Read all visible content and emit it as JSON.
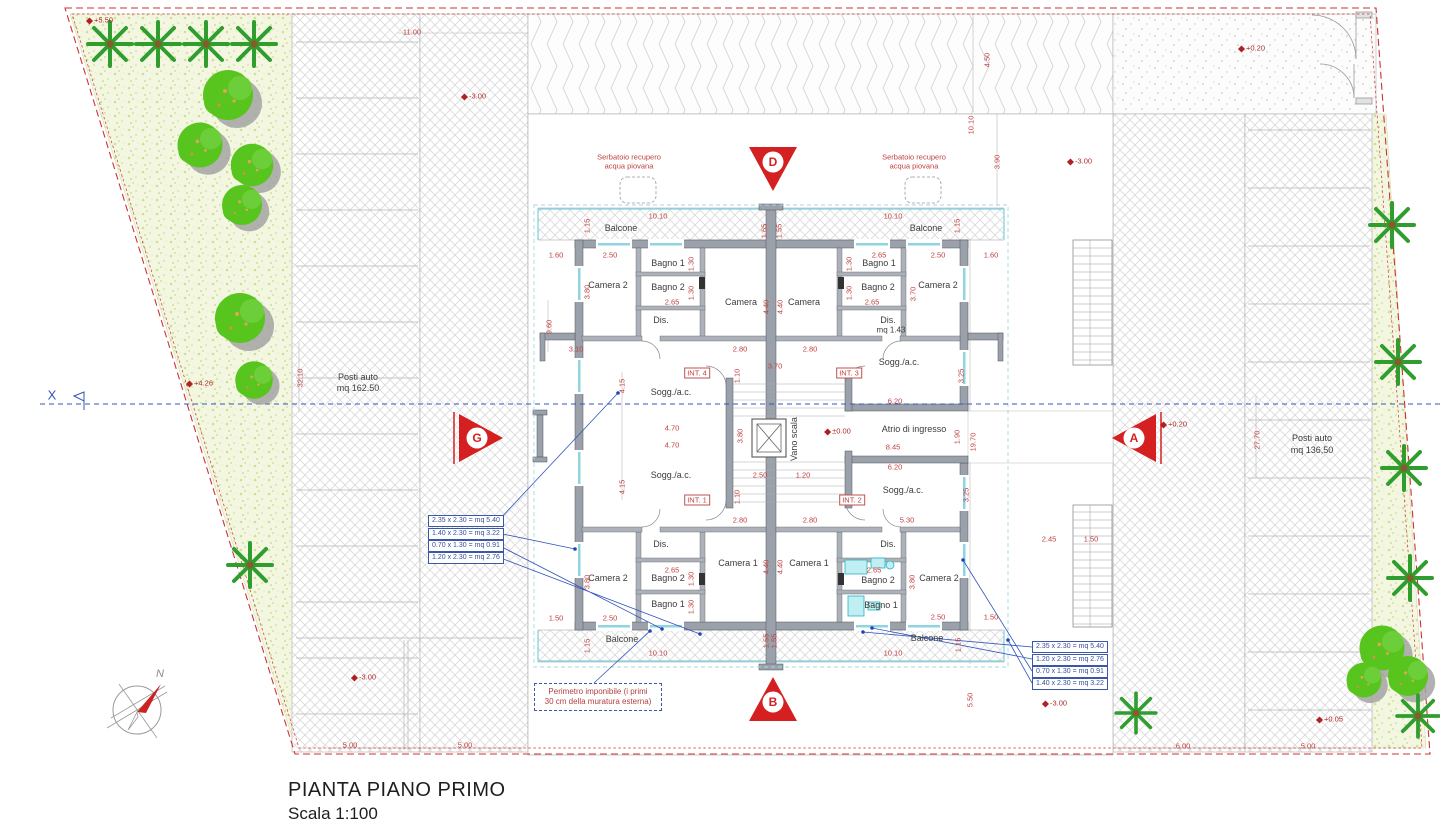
{
  "title_block": {
    "title": "PIANTA PIANO PRIMO",
    "scale": "Scala 1:100"
  },
  "axis": {
    "label": "X"
  },
  "compass": {
    "north": "N"
  },
  "colors": {
    "dimension_red": "#c04040",
    "boundary_red": "#cc3333",
    "axis_blue": "#3355bb",
    "annotation_blue": "#35509c",
    "wall_gray": "#9ba1aa",
    "tree_green": "#55c41e",
    "fixture_cyan": "#2ab3c0",
    "marker_red": "#d42020"
  },
  "annotations": {
    "left": [
      "2.35 x 2.30 = mq 5.40",
      "1.40 x 2.30 = mq 3.22",
      "0.70 x 1.30 = mq 0.91",
      "1.20 x 2.30 = mq 2.76"
    ],
    "right": [
      "2.35 x 2.30 = mq 5.40",
      "1.20 x 2.30 = mq 2.76",
      "0.70 x 1.30 = mq 0.91",
      "1.40 x 2.30 = mq 3.22"
    ]
  },
  "perimeter_note": {
    "line1": "Perimetro imponibile (i primi",
    "line2": "30 cm della muratura esterna)"
  },
  "labels": [
    {
      "t": "+5.50",
      "x": 100,
      "y": 20,
      "c": "level",
      "n": "level-marker"
    },
    {
      "t": "11.00",
      "x": 412,
      "y": 32,
      "c": "dim",
      "n": "dimension-label"
    },
    {
      "t": "-3.00",
      "x": 474,
      "y": 96,
      "c": "level",
      "n": "level-marker"
    },
    {
      "t": "+0.20",
      "x": 1252,
      "y": 48,
      "c": "level",
      "n": "level-marker"
    },
    {
      "t": "4.50",
      "x": 987,
      "y": 60,
      "c": "dimv",
      "n": "dimension-label"
    },
    {
      "t": "10.10",
      "x": 971,
      "y": 125,
      "c": "dimv",
      "n": "dimension-label"
    },
    {
      "t": "3.90",
      "x": 997,
      "y": 162,
      "c": "dimv",
      "n": "dimension-label"
    },
    {
      "t": "-3.00",
      "x": 1080,
      "y": 161,
      "c": "level",
      "n": "level-marker"
    },
    {
      "t": "+4.26",
      "x": 200,
      "y": 383,
      "c": "level",
      "n": "level-marker"
    },
    {
      "t": "Posti auto",
      "x": 358,
      "y": 377,
      "c": "room",
      "n": "parking-label"
    },
    {
      "t": "mq 162.50",
      "x": 358,
      "y": 388,
      "c": "room",
      "n": "parking-label"
    },
    {
      "t": "32.10",
      "x": 300,
      "y": 378,
      "c": "dimv",
      "n": "dimension-label"
    },
    {
      "t": "Posti auto",
      "x": 1312,
      "y": 438,
      "c": "room",
      "n": "parking-label"
    },
    {
      "t": "mq 136,50",
      "x": 1312,
      "y": 450,
      "c": "room",
      "n": "parking-label"
    },
    {
      "t": "27.70",
      "x": 1257,
      "y": 440,
      "c": "dimv",
      "n": "dimension-label"
    },
    {
      "t": "Serbatoio recupero",
      "x": 629,
      "y": 157,
      "c": "red-note",
      "n": "tank-label"
    },
    {
      "t": "acqua piovana",
      "x": 629,
      "y": 166,
      "c": "red-note",
      "n": "tank-label"
    },
    {
      "t": "Serbatoio recupero",
      "x": 914,
      "y": 157,
      "c": "red-note",
      "n": "tank-label"
    },
    {
      "t": "acqua piovana",
      "x": 914,
      "y": 166,
      "c": "red-note",
      "n": "tank-label"
    },
    {
      "t": "10.10",
      "x": 658,
      "y": 216,
      "c": "dim",
      "n": "dimension-label"
    },
    {
      "t": "10.10",
      "x": 893,
      "y": 216,
      "c": "dim",
      "n": "dimension-label"
    },
    {
      "t": "Balcone",
      "x": 621,
      "y": 228,
      "c": "room",
      "n": "room-label"
    },
    {
      "t": "Balcone",
      "x": 926,
      "y": 228,
      "c": "room",
      "n": "room-label"
    },
    {
      "t": "1.15",
      "x": 587,
      "y": 226,
      "c": "dimv",
      "n": "dimension-label"
    },
    {
      "t": "1.15",
      "x": 957,
      "y": 226,
      "c": "dimv",
      "n": "dimension-label"
    },
    {
      "t": "1.65",
      "x": 764,
      "y": 231,
      "c": "dimv",
      "n": "dimension-label"
    },
    {
      "t": "1.55",
      "x": 779,
      "y": 231,
      "c": "dimv",
      "n": "dimension-label"
    },
    {
      "t": "1.60",
      "x": 556,
      "y": 255,
      "c": "dim",
      "n": "dimension-label"
    },
    {
      "t": "2.50",
      "x": 610,
      "y": 255,
      "c": "dim",
      "n": "dimension-label"
    },
    {
      "t": "2.65",
      "x": 879,
      "y": 255,
      "c": "dim",
      "n": "dimension-label"
    },
    {
      "t": "2.50",
      "x": 938,
      "y": 255,
      "c": "dim",
      "n": "dimension-label"
    },
    {
      "t": "1.60",
      "x": 991,
      "y": 255,
      "c": "dim",
      "n": "dimension-label"
    },
    {
      "t": "Bagno 1",
      "x": 668,
      "y": 263,
      "c": "room",
      "n": "room-label"
    },
    {
      "t": "Bagno 1",
      "x": 879,
      "y": 263,
      "c": "room",
      "n": "room-label"
    },
    {
      "t": "1.30",
      "x": 691,
      "y": 264,
      "c": "dimv",
      "n": "dimension-label"
    },
    {
      "t": "1.30",
      "x": 849,
      "y": 264,
      "c": "dimv",
      "n": "dimension-label"
    },
    {
      "t": "Camera 2",
      "x": 608,
      "y": 285,
      "c": "room",
      "n": "room-label"
    },
    {
      "t": "Camera 2",
      "x": 938,
      "y": 285,
      "c": "room",
      "n": "room-label"
    },
    {
      "t": "Bagno 2",
      "x": 668,
      "y": 287,
      "c": "room",
      "n": "room-label"
    },
    {
      "t": "Bagno 2",
      "x": 878,
      "y": 287,
      "c": "room",
      "n": "room-label"
    },
    {
      "t": "1.30",
      "x": 691,
      "y": 293,
      "c": "dimv",
      "n": "dimension-label"
    },
    {
      "t": "1.30",
      "x": 849,
      "y": 293,
      "c": "dimv",
      "n": "dimension-label"
    },
    {
      "t": "3.80",
      "x": 587,
      "y": 292,
      "c": "dimv",
      "n": "dimension-label"
    },
    {
      "t": "3.70",
      "x": 913,
      "y": 294,
      "c": "dimv",
      "n": "dimension-label"
    },
    {
      "t": "2.65",
      "x": 672,
      "y": 302,
      "c": "dim",
      "n": "dimension-label"
    },
    {
      "t": "2.65",
      "x": 872,
      "y": 302,
      "c": "dim",
      "n": "dimension-label"
    },
    {
      "t": "Camera",
      "x": 741,
      "y": 302,
      "c": "room",
      "n": "room-label"
    },
    {
      "t": "Camera",
      "x": 804,
      "y": 302,
      "c": "room",
      "n": "room-label"
    },
    {
      "t": "4.40",
      "x": 766,
      "y": 307,
      "c": "dimv",
      "n": "dimension-label"
    },
    {
      "t": "4.40",
      "x": 780,
      "y": 307,
      "c": "dimv",
      "n": "dimension-label"
    },
    {
      "t": "Dis.",
      "x": 661,
      "y": 320,
      "c": "room",
      "n": "room-label"
    },
    {
      "t": "Dis.",
      "x": 888,
      "y": 320,
      "c": "room",
      "n": "room-label"
    },
    {
      "t": "mq 1.43",
      "x": 891,
      "y": 330,
      "c": "room-sm",
      "n": "room-label"
    },
    {
      "t": "9.60",
      "x": 549,
      "y": 327,
      "c": "dimv",
      "n": "dimension-label"
    },
    {
      "t": "3.10",
      "x": 576,
      "y": 349,
      "c": "dim",
      "n": "dimension-label"
    },
    {
      "t": "2.80",
      "x": 740,
      "y": 349,
      "c": "dim",
      "n": "dimension-label"
    },
    {
      "t": "2.80",
      "x": 810,
      "y": 349,
      "c": "dim",
      "n": "dimension-label"
    },
    {
      "t": "Sogg./a.c.",
      "x": 899,
      "y": 362,
      "c": "room",
      "n": "room-label"
    },
    {
      "t": "3.25",
      "x": 961,
      "y": 376,
      "c": "dimv",
      "n": "dimension-label"
    },
    {
      "t": "INT. 4",
      "x": 697,
      "y": 373,
      "c": "int",
      "n": "unit-label"
    },
    {
      "t": "INT. 3",
      "x": 849,
      "y": 373,
      "c": "int",
      "n": "unit-label"
    },
    {
      "t": "3.70",
      "x": 775,
      "y": 366,
      "c": "dim",
      "n": "dimension-label"
    },
    {
      "t": "1.10",
      "x": 737,
      "y": 376,
      "c": "dimv",
      "n": "dimension-label"
    },
    {
      "t": "Sogg./a.c.",
      "x": 671,
      "y": 392,
      "c": "room",
      "n": "room-label"
    },
    {
      "t": "4.15",
      "x": 622,
      "y": 386,
      "c": "dimv",
      "n": "dimension-label"
    },
    {
      "t": "6.20",
      "x": 895,
      "y": 401,
      "c": "dim",
      "n": "dimension-label"
    },
    {
      "t": "4.70",
      "x": 672,
      "y": 428,
      "c": "dim",
      "n": "dimension-label"
    },
    {
      "t": "4.70",
      "x": 672,
      "y": 445,
      "c": "dim",
      "n": "dimension-label"
    },
    {
      "t": "3.80",
      "x": 740,
      "y": 436,
      "c": "dimv",
      "n": "dimension-label"
    },
    {
      "t": "Vano scala",
      "x": 794,
      "y": 439,
      "c": "roomv",
      "n": "room-label"
    },
    {
      "t": "±0.00",
      "x": 838,
      "y": 431,
      "c": "level",
      "n": "level-marker"
    },
    {
      "t": "Atrio di ingresso",
      "x": 914,
      "y": 429,
      "c": "room",
      "n": "room-label"
    },
    {
      "t": "8.45",
      "x": 893,
      "y": 447,
      "c": "dim",
      "n": "dimension-label"
    },
    {
      "t": "1.90",
      "x": 957,
      "y": 437,
      "c": "dimv",
      "n": "dimension-label"
    },
    {
      "t": "19.70",
      "x": 973,
      "y": 442,
      "c": "dimv",
      "n": "dimension-label"
    },
    {
      "t": "+0.20",
      "x": 1174,
      "y": 424,
      "c": "level",
      "n": "level-marker"
    },
    {
      "t": "6.20",
      "x": 895,
      "y": 467,
      "c": "dim",
      "n": "dimension-label"
    },
    {
      "t": "2.50",
      "x": 760,
      "y": 475,
      "c": "dim",
      "n": "dimension-label"
    },
    {
      "t": "1.20",
      "x": 803,
      "y": 475,
      "c": "dim",
      "n": "dimension-label"
    },
    {
      "t": "Sogg./a.c.",
      "x": 671,
      "y": 475,
      "c": "room",
      "n": "room-label"
    },
    {
      "t": "4.15",
      "x": 622,
      "y": 487,
      "c": "dimv",
      "n": "dimension-label"
    },
    {
      "t": "1.10",
      "x": 737,
      "y": 497,
      "c": "dimv",
      "n": "dimension-label"
    },
    {
      "t": "Sogg./a.c.",
      "x": 903,
      "y": 490,
      "c": "room",
      "n": "room-label"
    },
    {
      "t": "INT. 1",
      "x": 697,
      "y": 500,
      "c": "int",
      "n": "unit-label"
    },
    {
      "t": "INT. 2",
      "x": 852,
      "y": 500,
      "c": "int",
      "n": "unit-label"
    },
    {
      "t": "3.25",
      "x": 966,
      "y": 495,
      "c": "dimv",
      "n": "dimension-label"
    },
    {
      "t": "2.80",
      "x": 740,
      "y": 520,
      "c": "dim",
      "n": "dimension-label"
    },
    {
      "t": "2.80",
      "x": 810,
      "y": 520,
      "c": "dim",
      "n": "dimension-label"
    },
    {
      "t": "5.30",
      "x": 907,
      "y": 520,
      "c": "dim",
      "n": "dimension-label"
    },
    {
      "t": "2.45",
      "x": 1049,
      "y": 539,
      "c": "dim",
      "n": "dimension-label"
    },
    {
      "t": "1.50",
      "x": 1091,
      "y": 539,
      "c": "dim",
      "n": "dimension-label"
    },
    {
      "t": "Dis.",
      "x": 661,
      "y": 544,
      "c": "room",
      "n": "room-label"
    },
    {
      "t": "Dis.",
      "x": 888,
      "y": 544,
      "c": "room",
      "n": "room-label"
    },
    {
      "t": "Camera 1",
      "x": 738,
      "y": 563,
      "c": "room",
      "n": "room-label"
    },
    {
      "t": "Camera 1",
      "x": 809,
      "y": 563,
      "c": "room",
      "n": "room-label"
    },
    {
      "t": "4.40",
      "x": 766,
      "y": 567,
      "c": "dimv",
      "n": "dimension-label"
    },
    {
      "t": "4.40",
      "x": 780,
      "y": 567,
      "c": "dimv",
      "n": "dimension-label"
    },
    {
      "t": "2.65",
      "x": 672,
      "y": 570,
      "c": "dim",
      "n": "dimension-label"
    },
    {
      "t": "2.65",
      "x": 874,
      "y": 570,
      "c": "dim",
      "n": "dimension-label"
    },
    {
      "t": "Camera 2",
      "x": 608,
      "y": 578,
      "c": "room",
      "n": "room-label"
    },
    {
      "t": "Camera 2",
      "x": 939,
      "y": 578,
      "c": "room",
      "n": "room-label"
    },
    {
      "t": "Bagno 2",
      "x": 668,
      "y": 578,
      "c": "room",
      "n": "room-label"
    },
    {
      "t": "Bagno 2",
      "x": 878,
      "y": 580,
      "c": "room",
      "n": "room-label"
    },
    {
      "t": "3.80",
      "x": 587,
      "y": 582,
      "c": "dimv",
      "n": "dimension-label"
    },
    {
      "t": "3.80",
      "x": 912,
      "y": 582,
      "c": "dimv",
      "n": "dimension-label"
    },
    {
      "t": "1.30",
      "x": 691,
      "y": 579,
      "c": "dimv",
      "n": "dimension-label"
    },
    {
      "t": "1.30",
      "x": 691,
      "y": 607,
      "c": "dimv",
      "n": "dimension-label"
    },
    {
      "t": "Bagno 1",
      "x": 668,
      "y": 604,
      "c": "room",
      "n": "room-label"
    },
    {
      "t": "Bagno 1",
      "x": 881,
      "y": 605,
      "c": "room",
      "n": "room-label"
    },
    {
      "t": "1.50",
      "x": 556,
      "y": 618,
      "c": "dim",
      "n": "dimension-label"
    },
    {
      "t": "2.50",
      "x": 610,
      "y": 618,
      "c": "dim",
      "n": "dimension-label"
    },
    {
      "t": "2.50",
      "x": 938,
      "y": 617,
      "c": "dim",
      "n": "dimension-label"
    },
    {
      "t": "1.50",
      "x": 991,
      "y": 617,
      "c": "dim",
      "n": "dimension-label"
    },
    {
      "t": "1.15",
      "x": 587,
      "y": 646,
      "c": "dimv",
      "n": "dimension-label"
    },
    {
      "t": "1.15",
      "x": 958,
      "y": 645,
      "c": "dimv",
      "n": "dimension-label"
    },
    {
      "t": "Balcone",
      "x": 622,
      "y": 639,
      "c": "room",
      "n": "room-label"
    },
    {
      "t": "Balcone",
      "x": 927,
      "y": 638,
      "c": "room",
      "n": "room-label"
    },
    {
      "t": "1.55",
      "x": 766,
      "y": 641,
      "c": "dimv",
      "n": "dimension-label"
    },
    {
      "t": "1.55",
      "x": 774,
      "y": 641,
      "c": "dimv",
      "n": "dimension-label"
    },
    {
      "t": "10.10",
      "x": 658,
      "y": 653,
      "c": "dim",
      "n": "dimension-label"
    },
    {
      "t": "10.10",
      "x": 893,
      "y": 653,
      "c": "dim",
      "n": "dimension-label"
    },
    {
      "t": "-3.00",
      "x": 364,
      "y": 677,
      "c": "level",
      "n": "level-marker"
    },
    {
      "t": "5.50",
      "x": 970,
      "y": 700,
      "c": "dimv",
      "n": "dimension-label"
    },
    {
      "t": "-3.00",
      "x": 1055,
      "y": 703,
      "c": "level",
      "n": "level-marker"
    },
    {
      "t": "+0.05",
      "x": 1330,
      "y": 719,
      "c": "level",
      "n": "level-marker"
    },
    {
      "t": "5.00",
      "x": 350,
      "y": 745,
      "c": "dim",
      "n": "dimension-label"
    },
    {
      "t": "5.00",
      "x": 465,
      "y": 745,
      "c": "dim",
      "n": "dimension-label"
    },
    {
      "t": "6.00",
      "x": 1183,
      "y": 746,
      "c": "dim",
      "n": "dimension-label"
    },
    {
      "t": "5.00",
      "x": 1308,
      "y": 746,
      "c": "dim",
      "n": "dimension-label"
    },
    {
      "t": "D",
      "x": 773,
      "y": 162,
      "c": "mletter",
      "n": "section-letter-d"
    },
    {
      "t": "B",
      "x": 773,
      "y": 702,
      "c": "mletter",
      "n": "section-letter-b"
    },
    {
      "t": "G",
      "x": 477,
      "y": 438,
      "c": "mletter",
      "n": "section-letter-g"
    },
    {
      "t": "A",
      "x": 1134,
      "y": 438,
      "c": "mletter",
      "n": "section-letter-a"
    }
  ]
}
